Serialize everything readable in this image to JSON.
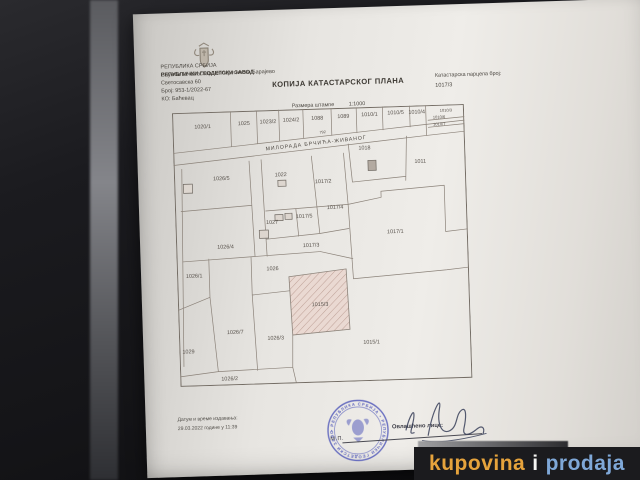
{
  "document": {
    "agency": {
      "line1": "РЕПУБЛИКА СРБИЈА",
      "line2": "РЕПУБЛИЧКИ ГЕОДЕТСКИ ЗАВОД",
      "line3": "Служба за катастар непокретности Барајево",
      "line4": "Светосавска 60",
      "line5": "Број: 953-1/2022-67",
      "line6": "КО: Баћевац"
    },
    "title": "КОПИЈА КАТАСТАРСКОГ ПЛАНА",
    "parcel_ref_label": "Катастарска парцела број:",
    "parcel_ref_value": "1017/3",
    "scale_label": "Размера штампе",
    "scale_value": "1:1000",
    "map": {
      "street": {
        "name": "МИЛОРАДА БРЧИЋА-ЖИВАНОГ",
        "number": "792"
      },
      "hatched_parcel": "1015/3",
      "parcels": [
        {
          "label": "1020/1",
          "x": 30,
          "y": 16
        },
        {
          "label": "1025",
          "x": 71,
          "y": 14
        },
        {
          "label": "1023/2",
          "x": 95,
          "y": 13
        },
        {
          "label": "1024/2",
          "x": 118,
          "y": 12
        },
        {
          "label": "1088",
          "x": 144,
          "y": 11
        },
        {
          "label": "1089",
          "x": 170,
          "y": 10
        },
        {
          "label": "1010/1",
          "x": 196,
          "y": 9
        },
        {
          "label": "1010/5",
          "x": 222,
          "y": 8
        },
        {
          "label": "1010/4",
          "x": 243,
          "y": 8
        },
        {
          "label": "1010/3",
          "x": 272,
          "y": 7,
          "small": true
        },
        {
          "label": "1010/6",
          "x": 265,
          "y": 13.5,
          "small": true
        },
        {
          "label": "1010/7",
          "x": 265,
          "y": 20.5,
          "small": true
        },
        {
          "label": "1018",
          "x": 190,
          "y": 42
        },
        {
          "label": "1011",
          "x": 245,
          "y": 57
        },
        {
          "label": "1026/5",
          "x": 47,
          "y": 68
        },
        {
          "label": "1022",
          "x": 106,
          "y": 66
        },
        {
          "label": "1017/2",
          "x": 148,
          "y": 74
        },
        {
          "label": "1027",
          "x": 96,
          "y": 113
        },
        {
          "label": "1017/5",
          "x": 128,
          "y": 108
        },
        {
          "label": "1017/4",
          "x": 159,
          "y": 100
        },
        {
          "label": "1026/4",
          "x": 49,
          "y": 136
        },
        {
          "label": "1017/3",
          "x": 134,
          "y": 137
        },
        {
          "label": "1017/1",
          "x": 218,
          "y": 126
        },
        {
          "label": "1026/1",
          "x": 17,
          "y": 164
        },
        {
          "label": "1026",
          "x": 95,
          "y": 159
        },
        {
          "label": "1015/3",
          "x": 141,
          "y": 196
        },
        {
          "label": "1026/7",
          "x": 56,
          "y": 221
        },
        {
          "label": "1026/3",
          "x": 96,
          "y": 228
        },
        {
          "label": "1015/1",
          "x": 191,
          "y": 235
        },
        {
          "label": "1029",
          "x": 9,
          "y": 239
        },
        {
          "label": "1026/2",
          "x": 49,
          "y": 267
        }
      ]
    },
    "footer": {
      "issue_label": "Датум и време издавања:",
      "issue_value": "29.03.2022 године у 11:39",
      "stamp_abbr": "М.П.",
      "stamp_text": "• РЕПУБЛИКА СРБИЈА • РЕПУБЛИЧКИ ГЕОДЕТСКИ ЗАВОД",
      "signature_label": "Овлашћено лице:"
    }
  },
  "watermark": {
    "word1": "kupovina",
    "word2": "i",
    "word3": "prodaja"
  },
  "colors": {
    "stamp_blue": "#4a52b8",
    "watermark_orange": "#e6a33c",
    "watermark_white": "#f5f5f2",
    "watermark_blue": "#7fa8d8",
    "paper": "#eceae6",
    "background": "#141417"
  }
}
